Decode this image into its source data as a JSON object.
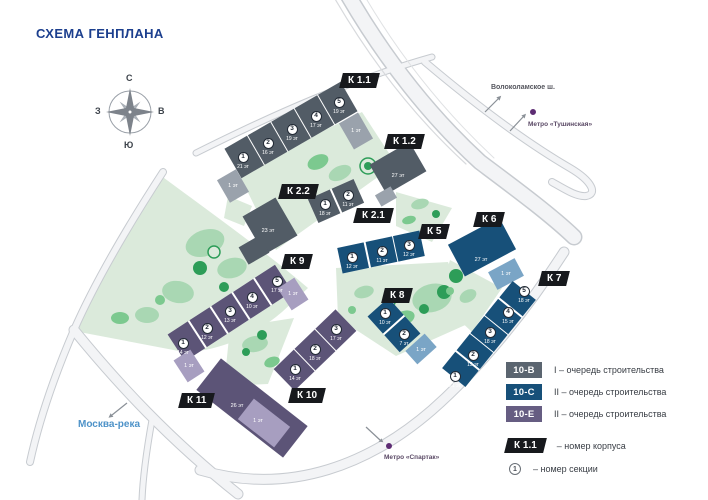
{
  "title": "СХЕМА ГЕНПЛАНА",
  "compass": {
    "north": "С",
    "south": "Ю",
    "west": "З",
    "east": "В"
  },
  "landmarks": {
    "highway_label": "Волоколамское ш.",
    "metro_tushinskaya_label": "Метро «Тушинская»",
    "river_label": "Москва-река",
    "metro_spartak_label": "Метро «Спартак»"
  },
  "buildings": [
    {
      "tag": "К 1.1",
      "sections": [
        {
          "n": "1",
          "floors": "21 эт"
        },
        {
          "n": "2",
          "floors": "16 эт"
        },
        {
          "n": "3",
          "floors": "19 эт"
        },
        {
          "n": "4",
          "floors": "17 эт"
        },
        {
          "n": "5",
          "floors": "19 эт"
        }
      ],
      "annexes": [
        "1 эт",
        "1 эт"
      ]
    },
    {
      "tag": "К 1.2",
      "floors": "27 эт"
    },
    {
      "tag": "К 2.1",
      "sections": [
        {
          "n": "1",
          "floors": "18 эт"
        },
        {
          "n": "2",
          "floors": "11 эт"
        }
      ]
    },
    {
      "tag": "К 2.2",
      "floors": "23 эт"
    },
    {
      "tag": "К 5",
      "sections": [
        {
          "n": "1",
          "floors": "12 эт"
        },
        {
          "n": "2",
          "floors": "11 эт"
        },
        {
          "n": "3",
          "floors": "12 эт"
        }
      ]
    },
    {
      "tag": "К 6",
      "floors": "27 эт",
      "annexes": [
        "1 эт"
      ]
    },
    {
      "tag": "К 7",
      "sections": [
        {
          "n": "1",
          "floors": "21 эт"
        },
        {
          "n": "2",
          "floors": "15 эт"
        },
        {
          "n": "3",
          "floors": "18 эт"
        },
        {
          "n": "4",
          "floors": "15 эт"
        },
        {
          "n": "5",
          "floors": "18 эт"
        }
      ]
    },
    {
      "tag": "К 8",
      "sections": [
        {
          "n": "1",
          "floors": "10 эт"
        },
        {
          "n": "2",
          "floors": "7 эт"
        }
      ],
      "annexes": [
        "1 эт"
      ]
    },
    {
      "tag": "К 9",
      "sections": [
        {
          "n": "1",
          "floors": "14 эт"
        },
        {
          "n": "2",
          "floors": "12 эт"
        },
        {
          "n": "3",
          "floors": "13 эт"
        },
        {
          "n": "4",
          "floors": "10 эт"
        },
        {
          "n": "5",
          "floors": "17 эт"
        }
      ],
      "annexes": [
        "1 эт",
        "1 эт"
      ]
    },
    {
      "tag": "К 10",
      "sections": [
        {
          "n": "1",
          "floors": "14 эт"
        },
        {
          "n": "2",
          "floors": "18 эт"
        },
        {
          "n": "3",
          "floors": "17 эт"
        }
      ]
    },
    {
      "tag": "К 11",
      "floors": "26 эт",
      "annexes": [
        "1 эт"
      ]
    }
  ],
  "legend": {
    "phases": [
      {
        "code": "10-В",
        "color": "#5b6570",
        "desc": "I – очередь строительства"
      },
      {
        "code": "10-С",
        "color": "#175079",
        "desc": "II – очередь строительства"
      },
      {
        "code": "10-Е",
        "color": "#665d82",
        "desc": "II – очередь строительства"
      }
    ],
    "korpus_tag": "К 1.1",
    "korpus_desc": "– номер корпуса",
    "section_symbol": "1",
    "section_desc": "– номер секции"
  }
}
